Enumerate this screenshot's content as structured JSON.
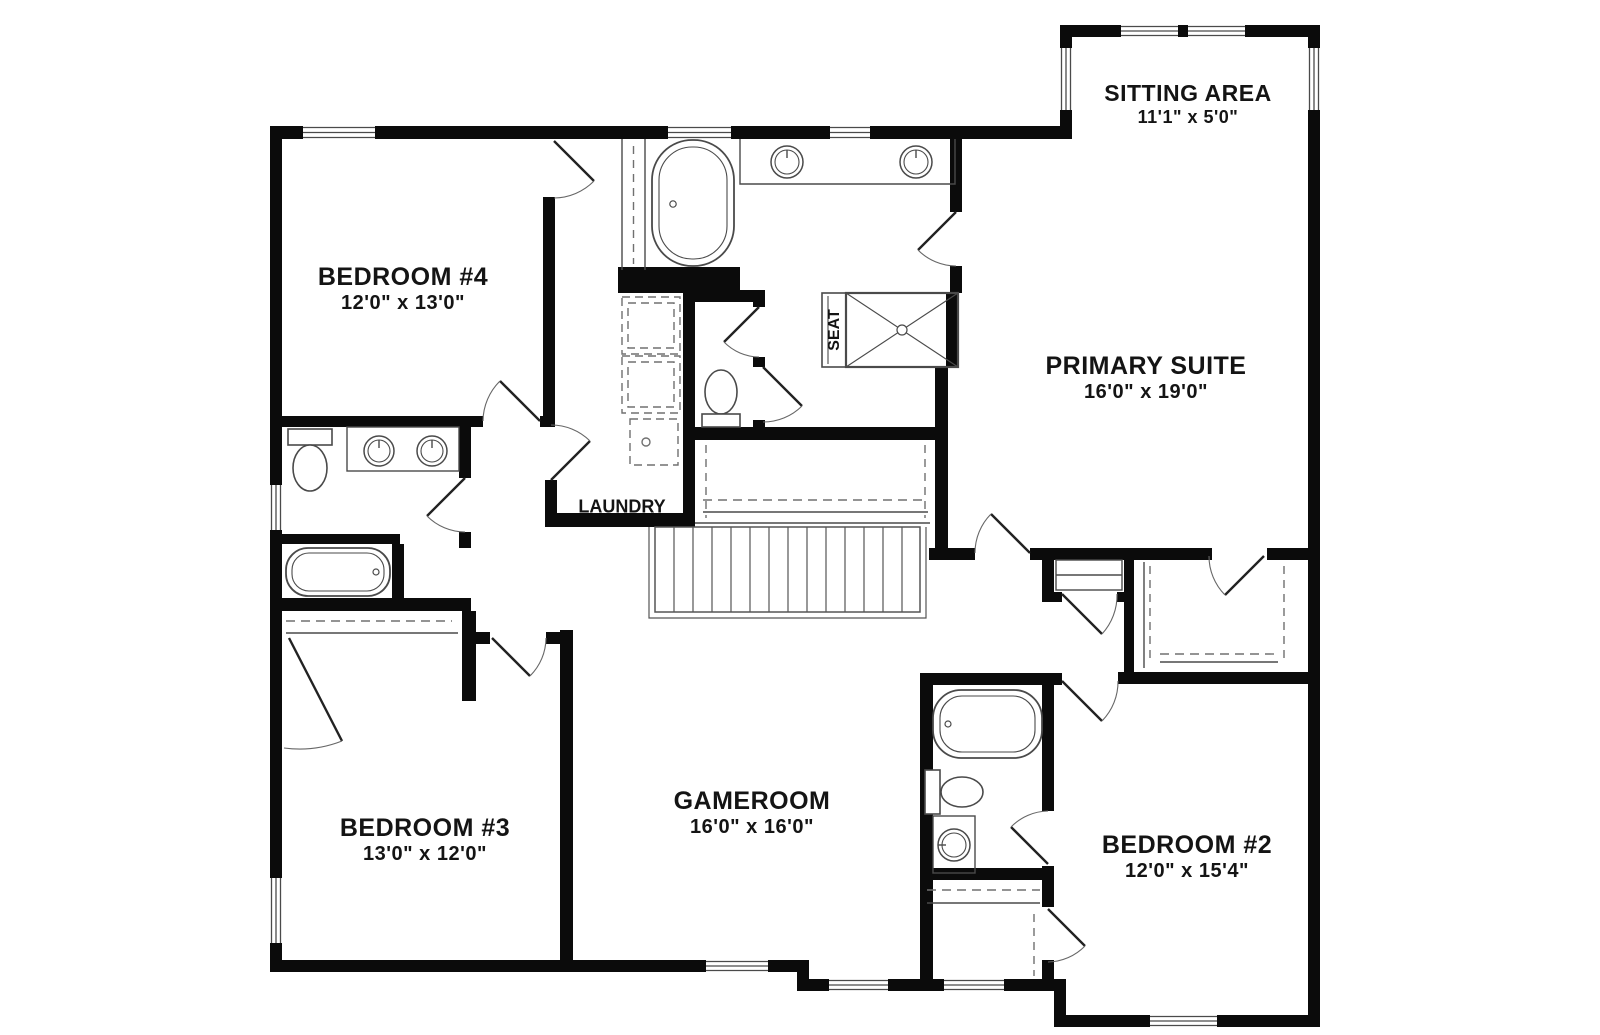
{
  "rooms": {
    "bedroom4": {
      "name": "BEDROOM #4",
      "dims": "12'0\" x 13'0\""
    },
    "sitting_area": {
      "name": "SITTING AREA",
      "dims": "11'1\" x 5'0\""
    },
    "primary_suite": {
      "name": "PRIMARY SUITE",
      "dims": "16'0\" x 19'0\""
    },
    "laundry": {
      "name": "LAUNDRY"
    },
    "shower_seat": {
      "name": "SEAT"
    },
    "bedroom3": {
      "name": "BEDROOM #3",
      "dims": "13'0\" x 12'0\""
    },
    "gameroom": {
      "name": "GAMEROOM",
      "dims": "16'0\" x 16'0\""
    },
    "bedroom2": {
      "name": "BEDROOM #2",
      "dims": "12'0\" x 15'4\""
    }
  },
  "colors": {
    "wall": "#0b0b0b",
    "fixture": "#4a4a4a",
    "dash": "#707070",
    "background": "#ffffff"
  }
}
